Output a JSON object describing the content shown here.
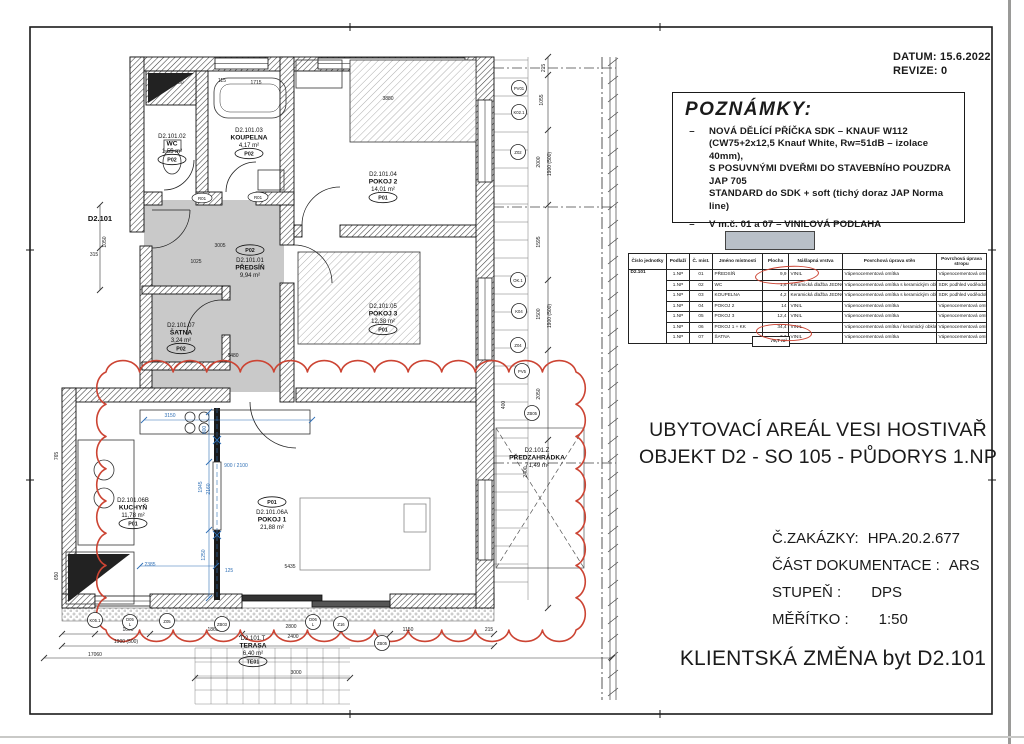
{
  "stamp": {
    "datum": "DATUM: 15.6.2022",
    "revize": "REVIZE: 0"
  },
  "notes": {
    "title": "POZNÁMKY:",
    "items": [
      {
        "lines": [
          "NOVÁ DĚLÍCÍ PŘÍČKA SDK – KNAUF W112",
          "(CW75+2x12,5 Knauf White, Rw=51dB – izolace 40mm),",
          "S POSUVNÝMI DVEŘMI DO STAVEBNÍHO POUZDRA JAP 705",
          "STANDARD do SDK + soft (tichý doraz JAP Norma line)"
        ]
      },
      {
        "lines": [
          "V m.č. 01 a 07 – VINILOVÁ PODLAHA"
        ],
        "swatch": true
      }
    ]
  },
  "room_table": {
    "unit": "D2.101",
    "headers": [
      "Číslo jednotky",
      "Podlaží",
      "Č. míst.",
      "Jméno místnosti",
      "Plocha",
      "Nášlapná vrstva",
      "Povrchová úprava stěn",
      "Povrchová úprava stropu"
    ],
    "rows": [
      [
        "1.NP",
        "01",
        "PŘEDSÍŇ",
        "9,9",
        "VINIL",
        "Vápenocementová omítka",
        "Vápenocementová omítka"
      ],
      [
        "1.NP",
        "02",
        "WC",
        "1,6",
        "Keramická dlažba JEDNOTKA",
        "Vápenocementová omítka s keramickým obkladem",
        "SDK podhled voděodolný"
      ],
      [
        "1.NP",
        "03",
        "KOUPELNA",
        "4,2",
        "Keramická dlažba JEDNOTKA",
        "Vápenocementová omítka s keramickým obkladem",
        "SDK podhled voděodolný"
      ],
      [
        "1.NP",
        "04",
        "POKOJ 2",
        "14",
        "VINIL",
        "Vápenocementová omítka",
        "Vápenocementová omítka"
      ],
      [
        "1.NP",
        "05",
        "POKOJ 3",
        "12,4",
        "VINIL",
        "Vápenocementová omítka",
        "Vápenocementová omítka"
      ],
      [
        "1.NP",
        "06",
        "POKOJ 1 + KK",
        "34,4",
        "VINIL",
        "Vápenocementová omítka / keramický obklad za kuch. linkou",
        "Vápenocementová omítka"
      ],
      [
        "1.NP",
        "07",
        "ŠATNA",
        "3,3",
        "VINIL",
        "Vápenocementová omítka",
        "Vápenocementová omítka"
      ]
    ],
    "total": "79,7 m²"
  },
  "titles": {
    "line1": "UBYTOVACÍ AREÁL VESI HOSTIVAŘ",
    "line2": "OBJEKT D2 - SO 105 - PŮDORYS 1.NP",
    "client_change": "KLIENTSKÁ ZMĚNA byt D2.101"
  },
  "info_lines": [
    {
      "label": "Č.ZAKÁZKY:",
      "value": "HPA.20.2.677"
    },
    {
      "label": "ČÁST DOKUMENTACE :",
      "value": "ARS"
    },
    {
      "label": "STUPEŇ :",
      "value": "DPS",
      "wide": true
    },
    {
      "label": "MĚŘÍTKO :",
      "value": "1:50",
      "wide": true
    }
  ],
  "plan": {
    "entrance_label": "D2.101",
    "rooms": [
      {
        "id": "D2.101.01",
        "name": "PŘEDSÍŇ",
        "area": "9,94 m²",
        "tag": "P02",
        "x": 250,
        "y": 262,
        "tag_above": true
      },
      {
        "id": "D2.101.02",
        "name": "WC",
        "area": "1,55 m²",
        "tag": "P02",
        "x": 172,
        "y": 138
      },
      {
        "id": "D2.101.03",
        "name": "KOUPELNA",
        "area": "4,17 m²",
        "tag": "P02",
        "x": 249,
        "y": 132
      },
      {
        "id": "D2.101.04",
        "name": "POKOJ 2",
        "area": "14,01 m²",
        "tag": "P01",
        "x": 383,
        "y": 176
      },
      {
        "id": "D2.101.05",
        "name": "POKOJ 3",
        "area": "12,38 m²",
        "tag": "P01",
        "x": 383,
        "y": 308
      },
      {
        "id": "D2.101.07",
        "name": "ŠATNA",
        "area": "3,24 m²",
        "tag": "P02",
        "x": 181,
        "y": 327
      },
      {
        "id": "D2.101.06B",
        "name": "KUCHYŇ",
        "area": "11,78 m²",
        "tag": "P01",
        "x": 133,
        "y": 502
      },
      {
        "id": "D2.101.06A",
        "name": "POKOJ 1",
        "area": "21,88 m²",
        "tag": "P01",
        "x": 272,
        "y": 514,
        "tag_above": true
      },
      {
        "id": "D2.101.Z",
        "name": "PŘEDZAHRÁDKA",
        "area": "71,49 m²",
        "x": 537,
        "y": 452
      },
      {
        "id": "D2.101.T",
        "name": "TERASA",
        "area": "6,40 m²",
        "tag": "TE01",
        "x": 253,
        "y": 640
      }
    ],
    "dims": [
      {
        "t": "1030",
        "x": 178,
        "y": 84
      },
      {
        "t": "115",
        "x": 222,
        "y": 82
      },
      {
        "t": "1715",
        "x": 256,
        "y": 84
      },
      {
        "t": "3880",
        "x": 388,
        "y": 100
      },
      {
        "t": "1050",
        "x": 106,
        "y": 242,
        "r": -90
      },
      {
        "t": "315",
        "x": 94,
        "y": 256
      },
      {
        "t": "3005",
        "x": 220,
        "y": 247
      },
      {
        "t": "1025",
        "x": 196,
        "y": 263
      },
      {
        "t": "1480",
        "x": 233,
        "y": 357
      },
      {
        "t": "1000",
        "x": 128,
        "y": 631
      },
      {
        "t": "1900 (500)",
        "x": 126,
        "y": 643
      },
      {
        "t": "1865",
        "x": 213,
        "y": 631
      },
      {
        "t": "2800",
        "x": 291,
        "y": 628
      },
      {
        "t": "2400",
        "x": 293,
        "y": 638
      },
      {
        "t": "1150",
        "x": 408,
        "y": 631
      },
      {
        "t": "215",
        "x": 489,
        "y": 631
      },
      {
        "t": "17060",
        "x": 95,
        "y": 656
      },
      {
        "t": "3000",
        "x": 296,
        "y": 674
      },
      {
        "t": "215",
        "x": 545,
        "y": 68,
        "r": -90
      },
      {
        "t": "1055",
        "x": 543,
        "y": 100,
        "r": -90
      },
      {
        "t": "2000",
        "x": 540,
        "y": 162,
        "r": -90
      },
      {
        "t": "1900 (500)",
        "x": 551,
        "y": 164,
        "r": -90
      },
      {
        "t": "1595",
        "x": 540,
        "y": 242,
        "r": -90
      },
      {
        "t": "1500",
        "x": 540,
        "y": 314,
        "r": -90
      },
      {
        "t": "1900 (500)",
        "x": 551,
        "y": 316,
        "r": -90
      },
      {
        "t": "2050",
        "x": 540,
        "y": 394,
        "r": -90
      },
      {
        "t": "2400",
        "x": 527,
        "y": 472,
        "r": -90
      },
      {
        "t": "400",
        "x": 505,
        "y": 405,
        "r": -90
      },
      {
        "t": "5435",
        "x": 290,
        "y": 568
      },
      {
        "t": "765",
        "x": 58,
        "y": 456,
        "r": -90
      },
      {
        "t": "650",
        "x": 58,
        "y": 576,
        "r": -90
      },
      {
        "t": "3150",
        "x": 170,
        "y": 417,
        "c": "b"
      },
      {
        "t": "800",
        "x": 206,
        "y": 430,
        "r": -90,
        "c": "b"
      },
      {
        "t": "1945",
        "x": 202,
        "y": 487,
        "r": -90,
        "c": "b"
      },
      {
        "t": "2160",
        "x": 210,
        "y": 489,
        "r": -90,
        "c": "b"
      },
      {
        "t": "1250",
        "x": 205,
        "y": 555,
        "r": -90,
        "c": "b"
      },
      {
        "t": "2385",
        "x": 150,
        "y": 566,
        "c": "b"
      },
      {
        "t": "125",
        "x": 229,
        "y": 572,
        "c": "b"
      },
      {
        "t": "900 / 2100",
        "x": 236,
        "y": 467,
        "c": "b"
      }
    ],
    "element_tags": [
      {
        "t": "K05.1",
        "x": 95,
        "y": 620
      },
      {
        "t": "D05 L",
        "x": 130,
        "y": 622
      },
      {
        "t": "Z05",
        "x": 167,
        "y": 621
      },
      {
        "t": "ZB03",
        "x": 222,
        "y": 624
      },
      {
        "t": "D06 L",
        "x": 313,
        "y": 622
      },
      {
        "t": "Z16",
        "x": 341,
        "y": 624
      },
      {
        "t": "ZB05",
        "x": 382,
        "y": 643
      },
      {
        "t": "PV01",
        "x": 519,
        "y": 88
      },
      {
        "t": "K02.1",
        "x": 519,
        "y": 112
      },
      {
        "t": "Z02",
        "x": 518,
        "y": 152
      },
      {
        "t": "OK.1",
        "x": 518,
        "y": 280
      },
      {
        "t": "K04",
        "x": 519,
        "y": 311
      },
      {
        "t": "Z04",
        "x": 518,
        "y": 345
      },
      {
        "t": "PV5",
        "x": 522,
        "y": 371
      },
      {
        "t": "ZB05",
        "x": 532,
        "y": 413
      }
    ],
    "door_tags": [
      {
        "t": "R01",
        "x": 202,
        "y": 198
      },
      {
        "t": "R01",
        "x": 258,
        "y": 197
      }
    ]
  },
  "colors": {
    "highlight_gray": "#c9c9c9",
    "revision_red": "#cc4433",
    "dim_blue": "#2f6fb5",
    "swatch_gray": "#b9c0c8"
  }
}
